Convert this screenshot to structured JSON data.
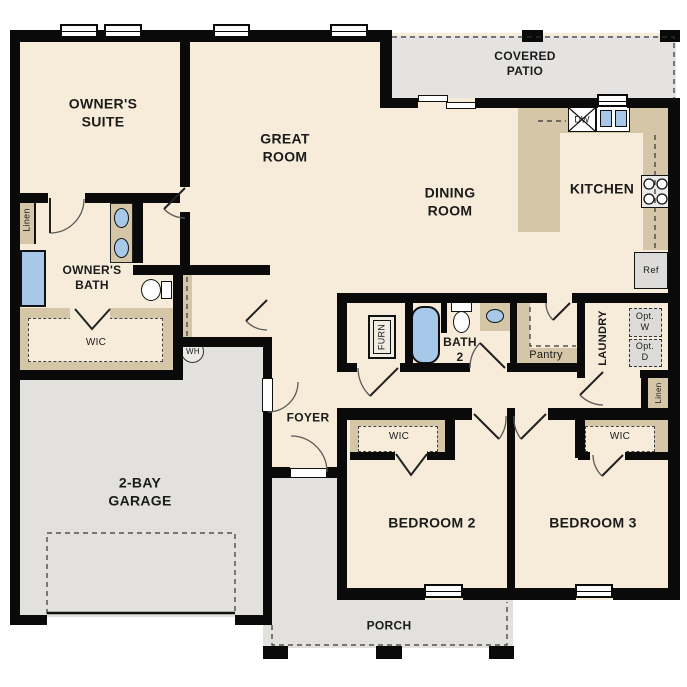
{
  "rooms": {
    "owners_suite": "OWNER'S\nSUITE",
    "great_room": "GREAT\nROOM",
    "covered_patio": "COVERED\nPATIO",
    "dining_room": "DINING\nROOM",
    "kitchen": "KITCHEN",
    "owners_bath": "OWNER'S\nBATH",
    "bath2": "BATH\n2",
    "garage": "2-BAY\nGARAGE",
    "foyer": "FOYER",
    "bedroom2": "BEDROOM 2",
    "bedroom3": "BEDROOM 3",
    "porch": "PORCH",
    "laundry": "LAUNDRY",
    "pantry": "Pantry",
    "wic": "WIC",
    "linen": "Linen"
  },
  "fixtures": {
    "wh": "WH",
    "ref": "Ref",
    "dw": "DW",
    "opt_w": "Opt.\nW",
    "opt_d": "Opt.\nD",
    "furn": "FURN"
  },
  "colors": {
    "floor": "#f6ecd9",
    "counter": "#d4c6a6",
    "concrete": "#e2e1de",
    "fixture_blue": "#a7c8e9",
    "wall": "#0a0a0a"
  }
}
